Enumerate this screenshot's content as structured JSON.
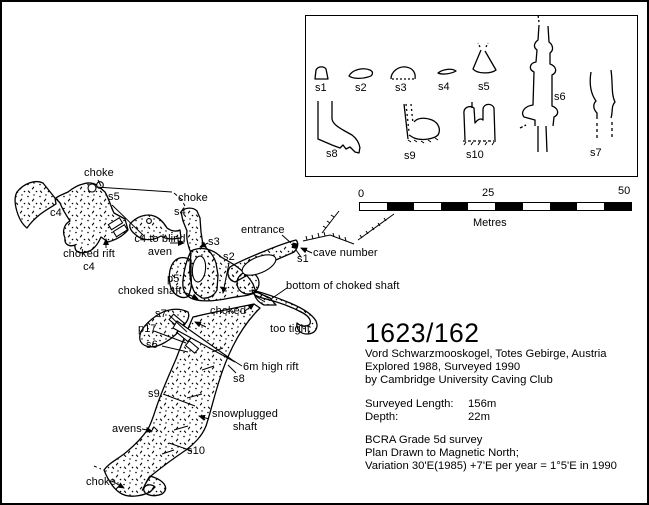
{
  "plan": {
    "labels": [
      {
        "id": "choke-nw",
        "text": "choke"
      },
      {
        "id": "c4-west",
        "text": "c4"
      },
      {
        "id": "s5",
        "text": "s5"
      },
      {
        "id": "choked-rift-c4",
        "text": "choked rift\nc4"
      },
      {
        "id": "c4-to-blind-aven",
        "text": "c4 to blind\naven"
      },
      {
        "id": "choke-mid",
        "text": "choke"
      },
      {
        "id": "s4",
        "text": "s4"
      },
      {
        "id": "s3",
        "text": "s3"
      },
      {
        "id": "entrance",
        "text": "entrance"
      },
      {
        "id": "s1",
        "text": "s1"
      },
      {
        "id": "cave-number",
        "text": "cave number"
      },
      {
        "id": "s2",
        "text": "s2"
      },
      {
        "id": "p5",
        "text": "p5"
      },
      {
        "id": "choked-shaft",
        "text": "choked shaft"
      },
      {
        "id": "bottom-of-choked-shaft",
        "text": "bottom of choked shaft"
      },
      {
        "id": "choked",
        "text": "choked"
      },
      {
        "id": "too-tight",
        "text": "too tight"
      },
      {
        "id": "s7",
        "text": "s7"
      },
      {
        "id": "p17",
        "text": "p17"
      },
      {
        "id": "s6",
        "text": "s6"
      },
      {
        "id": "6m-high-rift",
        "text": "6m high rift"
      },
      {
        "id": "s8",
        "text": "s8"
      },
      {
        "id": "s9",
        "text": "s9"
      },
      {
        "id": "snowplugged-shaft",
        "text": "snowplugged\nshaft"
      },
      {
        "id": "avens",
        "text": "avens"
      },
      {
        "id": "s10",
        "text": "s10"
      },
      {
        "id": "choke-bottom",
        "text": "choke"
      }
    ]
  },
  "inset": {
    "section_labels": [
      {
        "id": "s1",
        "text": "s1"
      },
      {
        "id": "s2",
        "text": "s2"
      },
      {
        "id": "s3",
        "text": "s3"
      },
      {
        "id": "s4",
        "text": "s4"
      },
      {
        "id": "s5",
        "text": "s5"
      },
      {
        "id": "s6",
        "text": "s6"
      },
      {
        "id": "s8",
        "text": "s8"
      },
      {
        "id": "s9",
        "text": "s9"
      },
      {
        "id": "s10",
        "text": "s10"
      },
      {
        "id": "s7",
        "text": "s7"
      }
    ]
  },
  "scalebar": {
    "tick_start": "0",
    "tick_mid": "25",
    "tick_end": "50",
    "unit": "Metres"
  },
  "title_block": {
    "cave_number": "1623/162",
    "location": "Vord Schwarzmooskogel, Totes Gebirge, Austria",
    "explored": "Explored 1988, Surveyed 1990",
    "club": "by Cambridge University Caving Club",
    "surveyed_length_label": "Surveyed Length:",
    "surveyed_length_value": "156m",
    "depth_label": "Depth:",
    "depth_value": "22m",
    "grade": "BCRA Grade 5d survey",
    "north_note": "Plan Drawn to Magnetic North;",
    "variation_note": "Variation 30'E(1985) +7'E per year = 1°5'E in 1990"
  },
  "colors": {
    "ink": "#000000",
    "paper": "#ffffff"
  }
}
